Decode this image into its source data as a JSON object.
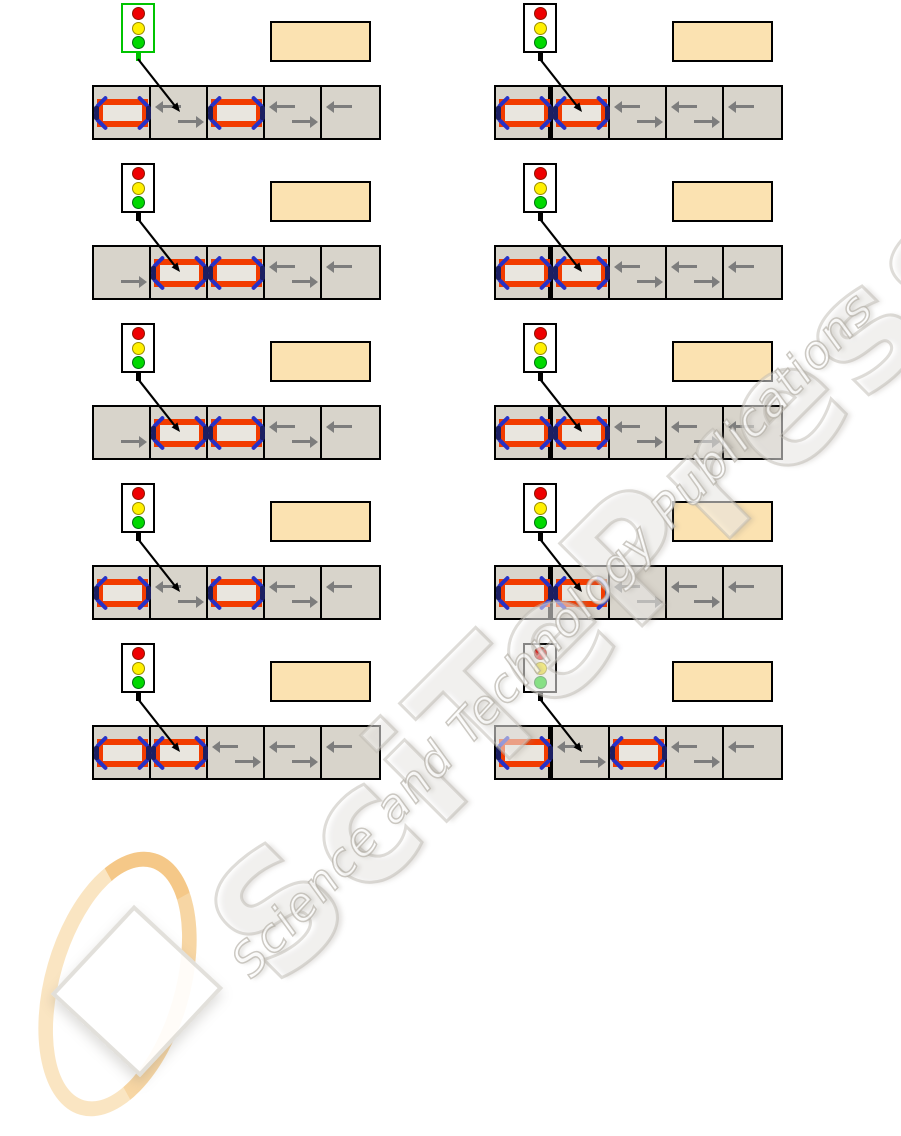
{
  "watermark": {
    "big_text": "SciTePress",
    "script_text": "Science and Technology Publications"
  },
  "colors": {
    "page_bg": "#ffffff",
    "cell_bg": "#d8d4cb",
    "cell_border": "#000000",
    "label_box_bg": "#fbe2b1",
    "car_body": "#f23c00",
    "car_interior": "#e9e6df",
    "car_trim": "#2631c8",
    "car_wheel": "#1c1f63",
    "lane_arrow": "#7d7d7d",
    "lamp_red": "#ee0000",
    "lamp_yellow": "#fff000",
    "lamp_green": "#00d900",
    "light_box_bg": "#ffffff",
    "light_border_black": "#000000",
    "light_border_green": "#00c400",
    "pointer_arrow": "#000000"
  },
  "panels": [
    {
      "id": "step-1-left",
      "column": "left",
      "row": 1,
      "light": {
        "lamps": [
          "red",
          "yellow",
          "green"
        ],
        "border": "green"
      },
      "pointer_target_cell": 2,
      "stop_line": false,
      "cells": [
        {
          "content": "car"
        },
        {
          "content": "lane-arrows",
          "arrows": [
            "left",
            "right"
          ]
        },
        {
          "content": "car"
        },
        {
          "content": "lane-arrows",
          "arrows": [
            "left",
            "right"
          ]
        },
        {
          "content": "lane-arrows",
          "arrows": [
            "left"
          ]
        }
      ]
    },
    {
      "id": "step-1-right",
      "column": "right",
      "row": 1,
      "light": {
        "lamps": [
          "red",
          "yellow",
          "green"
        ],
        "border": "black"
      },
      "pointer_target_cell": 2,
      "stop_line": true,
      "cells": [
        {
          "content": "car"
        },
        {
          "content": "car"
        },
        {
          "content": "lane-arrows",
          "arrows": [
            "left",
            "right"
          ]
        },
        {
          "content": "lane-arrows",
          "arrows": [
            "left",
            "right"
          ]
        },
        {
          "content": "lane-arrows",
          "arrows": [
            "left"
          ]
        }
      ]
    },
    {
      "id": "step-2-left",
      "column": "left",
      "row": 2,
      "light": {
        "lamps": [
          "red",
          "yellow",
          "green"
        ],
        "border": "black"
      },
      "pointer_target_cell": 2,
      "stop_line": false,
      "cells": [
        {
          "content": "lane-arrows",
          "arrows": [
            "right"
          ]
        },
        {
          "content": "car"
        },
        {
          "content": "car"
        },
        {
          "content": "lane-arrows",
          "arrows": [
            "left",
            "right"
          ]
        },
        {
          "content": "lane-arrows",
          "arrows": [
            "left"
          ]
        }
      ]
    },
    {
      "id": "step-2-right",
      "column": "right",
      "row": 2,
      "light": {
        "lamps": [
          "red",
          "yellow",
          "green"
        ],
        "border": "black"
      },
      "pointer_target_cell": 2,
      "stop_line": true,
      "cells": [
        {
          "content": "car"
        },
        {
          "content": "car"
        },
        {
          "content": "lane-arrows",
          "arrows": [
            "left",
            "right"
          ]
        },
        {
          "content": "lane-arrows",
          "arrows": [
            "left",
            "right"
          ]
        },
        {
          "content": "lane-arrows",
          "arrows": [
            "left"
          ]
        }
      ]
    },
    {
      "id": "step-3-left",
      "column": "left",
      "row": 3,
      "light": {
        "lamps": [
          "red",
          "yellow",
          "green"
        ],
        "border": "black"
      },
      "pointer_target_cell": 2,
      "stop_line": false,
      "cells": [
        {
          "content": "lane-arrows",
          "arrows": [
            "right"
          ]
        },
        {
          "content": "car"
        },
        {
          "content": "car"
        },
        {
          "content": "lane-arrows",
          "arrows": [
            "left",
            "right"
          ]
        },
        {
          "content": "lane-arrows",
          "arrows": [
            "left"
          ]
        }
      ]
    },
    {
      "id": "step-3-right",
      "column": "right",
      "row": 3,
      "light": {
        "lamps": [
          "red",
          "yellow",
          "green"
        ],
        "border": "black"
      },
      "pointer_target_cell": 2,
      "stop_line": true,
      "cells": [
        {
          "content": "car"
        },
        {
          "content": "car"
        },
        {
          "content": "lane-arrows",
          "arrows": [
            "left",
            "right"
          ]
        },
        {
          "content": "lane-arrows",
          "arrows": [
            "left",
            "right"
          ]
        },
        {
          "content": "lane-arrows",
          "arrows": [
            "left"
          ]
        }
      ]
    },
    {
      "id": "step-4-left",
      "column": "left",
      "row": 4,
      "light": {
        "lamps": [
          "red",
          "yellow",
          "green"
        ],
        "border": "black"
      },
      "pointer_target_cell": 2,
      "stop_line": false,
      "cells": [
        {
          "content": "car"
        },
        {
          "content": "lane-arrows",
          "arrows": [
            "left",
            "right"
          ]
        },
        {
          "content": "car"
        },
        {
          "content": "lane-arrows",
          "arrows": [
            "left",
            "right"
          ]
        },
        {
          "content": "lane-arrows",
          "arrows": [
            "left"
          ]
        }
      ]
    },
    {
      "id": "step-4-right",
      "column": "right",
      "row": 4,
      "light": {
        "lamps": [
          "red",
          "yellow",
          "green"
        ],
        "border": "black"
      },
      "pointer_target_cell": 2,
      "stop_line": true,
      "cells": [
        {
          "content": "car"
        },
        {
          "content": "car"
        },
        {
          "content": "lane-arrows",
          "arrows": [
            "left",
            "right"
          ]
        },
        {
          "content": "lane-arrows",
          "arrows": [
            "left",
            "right"
          ]
        },
        {
          "content": "lane-arrows",
          "arrows": [
            "left"
          ]
        }
      ]
    },
    {
      "id": "step-5-left",
      "column": "left",
      "row": 5,
      "light": {
        "lamps": [
          "red",
          "yellow",
          "green"
        ],
        "border": "black"
      },
      "pointer_target_cell": 2,
      "stop_line": false,
      "cells": [
        {
          "content": "car"
        },
        {
          "content": "car"
        },
        {
          "content": "lane-arrows",
          "arrows": [
            "left",
            "right"
          ]
        },
        {
          "content": "lane-arrows",
          "arrows": [
            "left",
            "right"
          ]
        },
        {
          "content": "lane-arrows",
          "arrows": [
            "left"
          ]
        }
      ]
    },
    {
      "id": "step-5-right",
      "column": "right",
      "row": 5,
      "light": {
        "lamps": [
          "red",
          "yellow",
          "green"
        ],
        "border": "black"
      },
      "pointer_target_cell": 2,
      "stop_line": true,
      "cells": [
        {
          "content": "car"
        },
        {
          "content": "lane-arrows",
          "arrows": [
            "left",
            "right"
          ]
        },
        {
          "content": "car"
        },
        {
          "content": "lane-arrows",
          "arrows": [
            "left",
            "right"
          ]
        },
        {
          "content": "lane-arrows",
          "arrows": [
            "left"
          ]
        }
      ]
    }
  ]
}
